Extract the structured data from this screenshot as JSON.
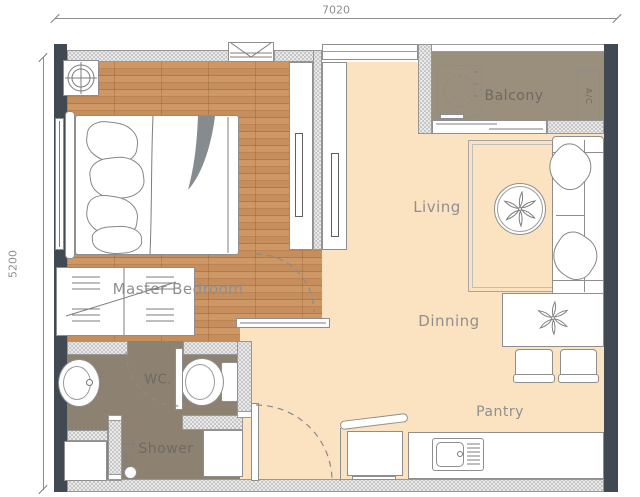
{
  "page": {
    "type": "apartment-floor-plan"
  },
  "dimensions": {
    "width_label": "7020",
    "height_label": "5200"
  },
  "rooms": {
    "master_bedroom": {
      "label": "Master Bedroom"
    },
    "living": {
      "label": "Living"
    },
    "dinning": {
      "label": "Dinning"
    },
    "pantry": {
      "label": "Pantry"
    },
    "balcony": {
      "label": "Balcony"
    },
    "wc": {
      "label": "WC."
    },
    "shower": {
      "label": "Shower"
    }
  },
  "equipment": {
    "ac": {
      "label": "A/C"
    }
  },
  "colors": {
    "wood_floor": "#c9905f",
    "tile_cream": "#fbe3c1",
    "balcony_floor": "#9a8f7d",
    "bathroom_floor": "#8d8172",
    "wall_dark": "#414a53",
    "wall_hatch_dot": "#6f6f6f",
    "line": "#8e8e8e",
    "label_text": "#8f8f8f"
  },
  "fixtures": {
    "bedroom": [
      "ceiling-light",
      "double-bed",
      "pillows",
      "blanket",
      "wardrobe",
      "tv-console",
      "tv"
    ],
    "living": [
      "rug",
      "coffee-table",
      "plant",
      "sofa",
      "cushions",
      "tv-console",
      "tv"
    ],
    "dining": [
      "dining-table",
      "plant",
      "chair",
      "chair"
    ],
    "pantry": [
      "kitchen-counter",
      "kitchen-sink",
      "refrigerator"
    ],
    "balcony": [
      "washing-machine",
      "air-conditioner",
      "sliding-door",
      "railing"
    ],
    "wc": [
      "wash-basin",
      "toilet",
      "door-swing"
    ],
    "shower": [
      "shower-mixer",
      "floor-drain",
      "storage-box",
      "cabinet"
    ],
    "entry": [
      "entrance-door-swing",
      "awning-window",
      "window"
    ]
  }
}
